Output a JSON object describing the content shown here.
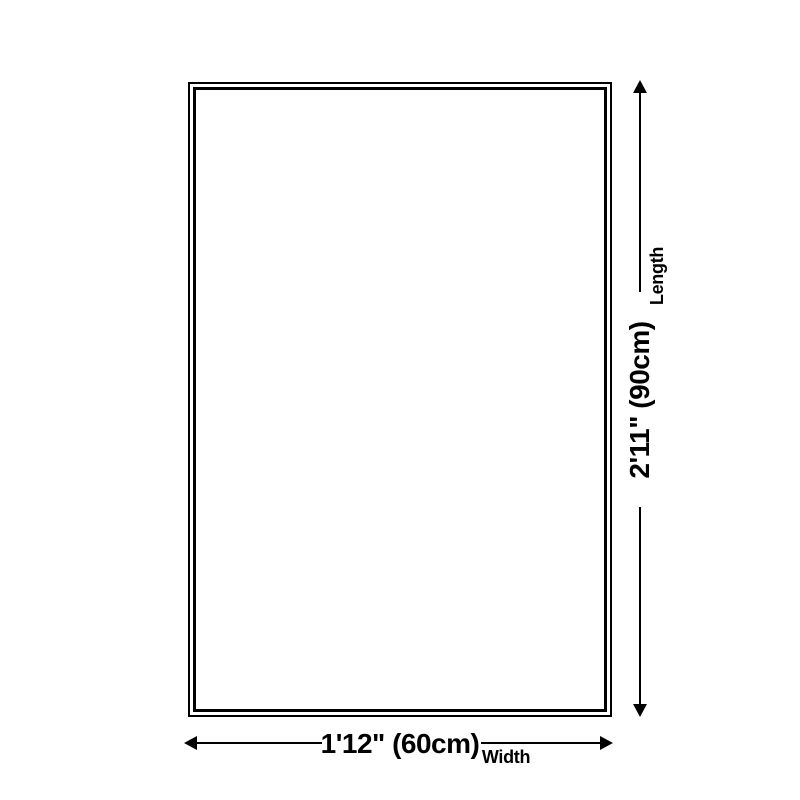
{
  "diagram": {
    "background_color": "#ffffff",
    "line_color": "#000000",
    "product": {
      "shape": "rectangle-double-outline"
    },
    "length_dimension": {
      "value": "2'11\" (90cm)",
      "label": "Length"
    },
    "width_dimension": {
      "value": "1'12\" (60cm)",
      "label": "Width"
    }
  }
}
